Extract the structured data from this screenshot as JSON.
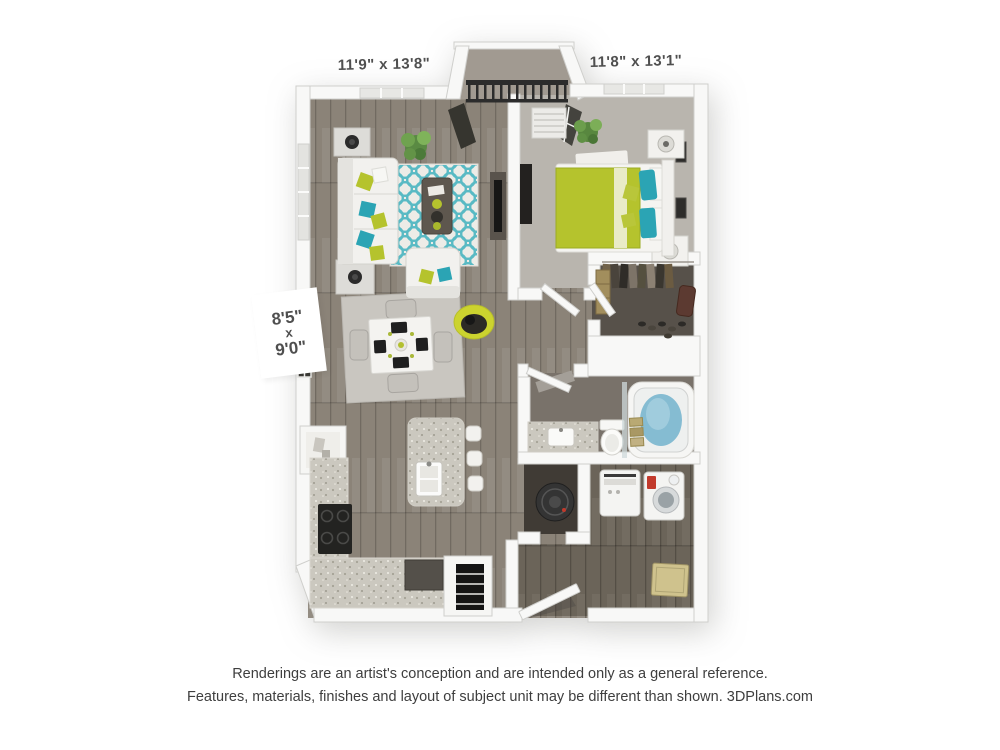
{
  "labels": {
    "living_room_dimensions": "11'9\" x 13'8\"",
    "bedroom_dimensions": "11'8\" x 13'1\"",
    "dining_nook_width": "8'5\"",
    "dining_nook_separator": "x",
    "dining_nook_depth": "9'0\""
  },
  "disclaimer": {
    "line1": "Renderings are an artist's conception and are intended only as a general reference.",
    "line2": "Features, materials, finishes and layout of subject unit may be different than shown. 3DPlans.com"
  },
  "colors": {
    "lime": "#b5c32d",
    "teal": "#2ba4b4",
    "rugteal": "#49b4c0",
    "wood": "#8b8378",
    "wood2": "#6b6459",
    "carpet": "#b9b5ae",
    "closetfloor": "#57514a",
    "bathfloor": "#79726a",
    "whfloor": "#403b35",
    "granite": "#cbc8bf",
    "water": "#85bcd2",
    "wall": "#f8f8f7",
    "walledge": "#cfcfcc",
    "ink": "#4f4f4f",
    "disclaimer_ink": "#3e3e3e"
  }
}
